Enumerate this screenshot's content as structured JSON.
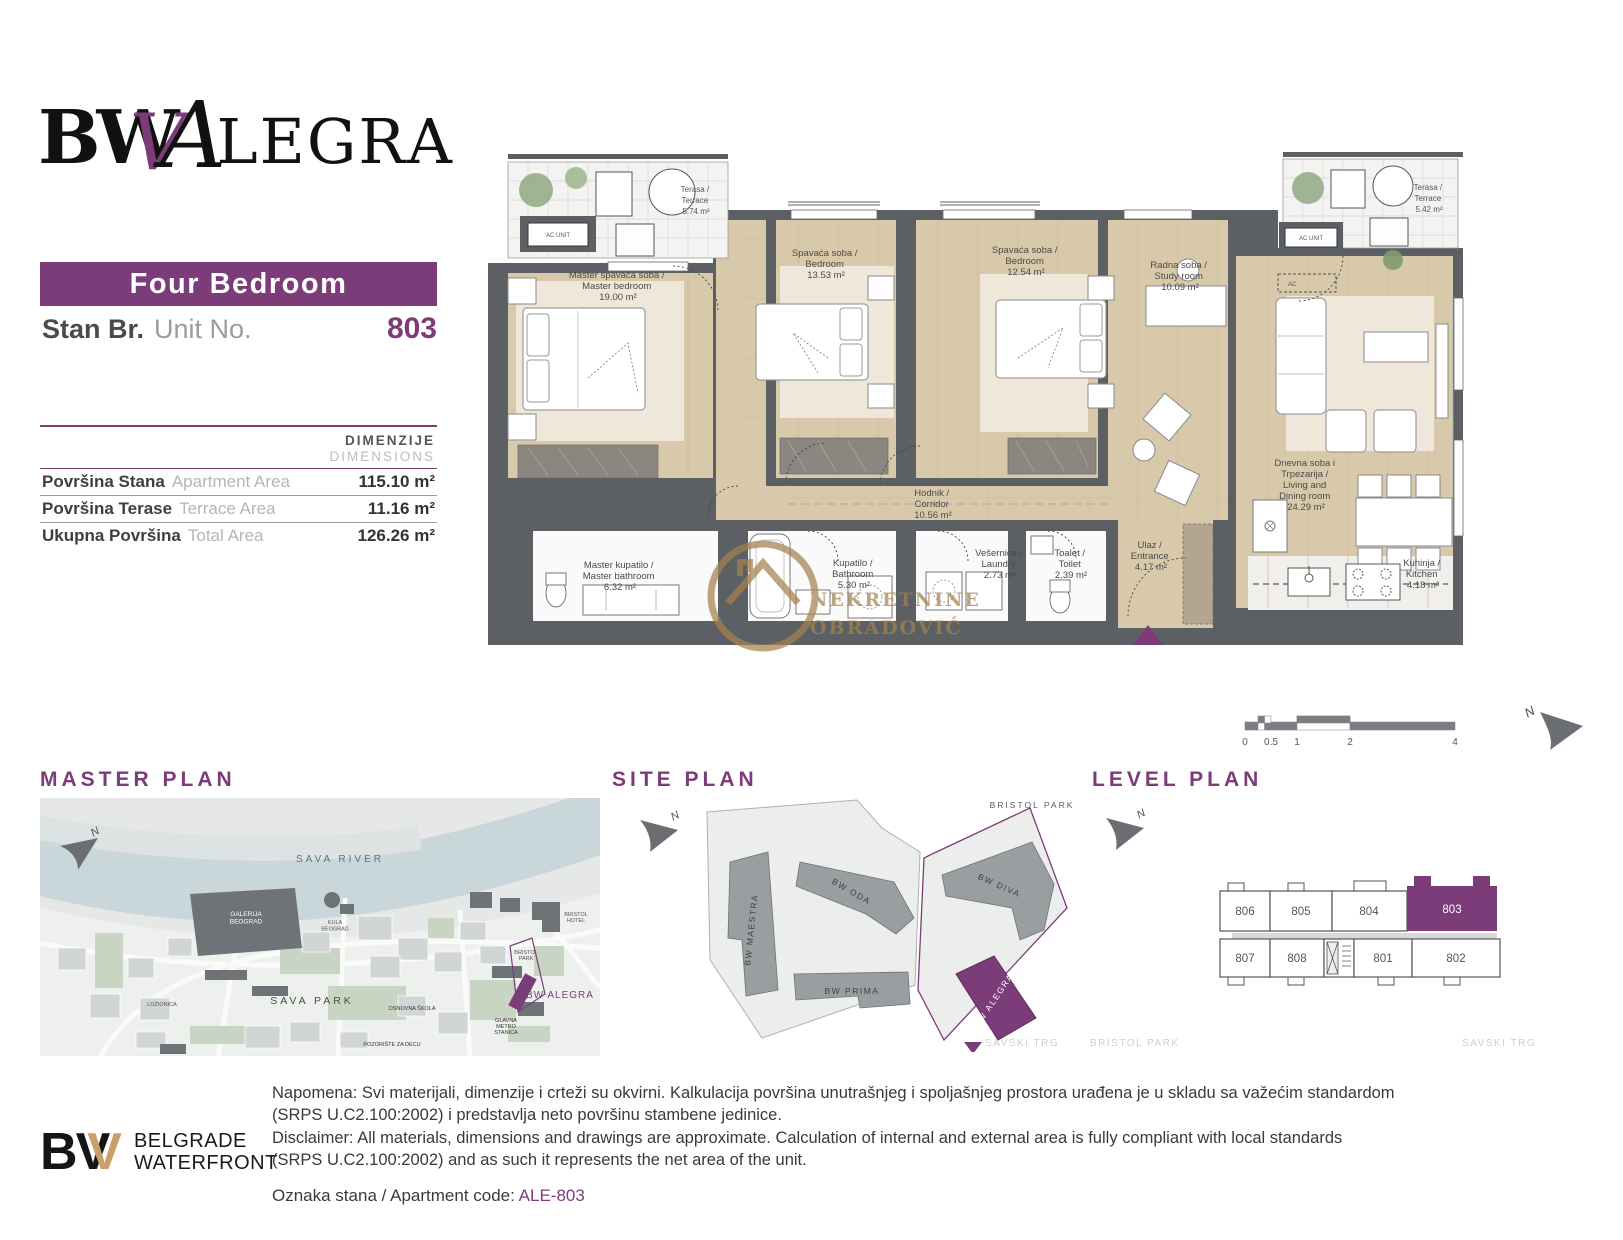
{
  "colors": {
    "accent": "#7b3c79",
    "wall": "#5c6064",
    "floor": "#d9c9ab",
    "rug": "#efe7d9",
    "terrace": "#f3f3f1",
    "bath": "#fafafa",
    "watermark_gold": "#a5824f",
    "logo_gold": "#c9a06a",
    "river": "#c9d6da",
    "map_green": "#c8d5c2",
    "map_block": "#d2d5d6",
    "map_dark": "#6e7377",
    "site_building": "#9a9ea1"
  },
  "header": {
    "bw": "BW",
    "v": "V",
    "a": "A",
    "legra": "LEGRA"
  },
  "unit": {
    "type": "Four Bedroom",
    "stan": "Stan Br.",
    "unit_no": "Unit No.",
    "number": "803"
  },
  "dimensions": {
    "dimenzije": "DIMENZIJE",
    "dimensions": "DIMENSIONS",
    "rows": [
      {
        "sr": "Površina Stana",
        "en": "Apartment Area",
        "value": "115.10 m²"
      },
      {
        "sr": "Površina Terase",
        "en": "Terrace Area",
        "value": "11.16 m²"
      },
      {
        "sr": "Ukupna Površina",
        "en": "Total Area",
        "value": "126.26 m²"
      }
    ]
  },
  "plan": {
    "north": "N",
    "ac": "AC UNIT",
    "ac_small": "AC",
    "watermark1": "NEKRETNINE",
    "watermark2": "OBRADOVIĆ",
    "rooms": {
      "terrace_left": {
        "l1": "Terasa /",
        "l2": "Terrace",
        "l3": "5.74 m²"
      },
      "terrace_right": {
        "l1": "Terasa /",
        "l2": "Terrace",
        "l3": "5.42 m²"
      },
      "master_bedroom": {
        "l1": "Master spavaća soba /",
        "l2": "Master bedroom",
        "l3": "19.00 m²"
      },
      "bedroom2": {
        "l1": "Spavaća soba /",
        "l2": "Bedroom",
        "l3": "13.53 m²"
      },
      "bedroom3": {
        "l1": "Spavaća soba /",
        "l2": "Bedroom",
        "l3": "12.54 m²"
      },
      "study": {
        "l1": "Radna soba /",
        "l2": "Study room",
        "l3": "10.09 m²"
      },
      "living": {
        "l1": "Dnevna soba i",
        "l2": "Trpezarija /",
        "l3": "Living and",
        "l4": "Dining room",
        "l5": "24.29 m²"
      },
      "corridor": {
        "l1": "Hodnik /",
        "l2": "Corridor",
        "l3": "10.56 m²"
      },
      "master_bath": {
        "l1": "Master kupatilo /",
        "l2": "Master bathroom",
        "l3": "6.32 m²"
      },
      "bathroom": {
        "l1": "Kupatilo /",
        "l2": "Bathroom",
        "l3": "5.30 m²"
      },
      "laundry": {
        "l1": "Vešernica /",
        "l2": "Laundry",
        "l3": "2.73 m²"
      },
      "toilet": {
        "l1": "Toalet /",
        "l2": "Toilet",
        "l3": "2.39 m²"
      },
      "entrance": {
        "l1": "Ulaz /",
        "l2": "Entrance",
        "l3": "4.17 m²"
      },
      "kitchen": {
        "l1": "Kuhinja /",
        "l2": "Kitchen",
        "l3": "4.18 m²"
      }
    }
  },
  "scale": {
    "t0": "0",
    "t1": "0.5",
    "t2": "1",
    "t3": "2",
    "t4": "4"
  },
  "master_plan": {
    "title": "MASTER PLAN",
    "river": "SAVA RIVER",
    "galerija1": "GALERIJA",
    "galerija2": "BEOGRAD",
    "kula1": "KULA",
    "kula2": "BEOGRAD",
    "sava_park": "SAVA PARK",
    "lozionica": "LOŽIONICA",
    "skola": "OSNOVNA ŠKOLA",
    "pozoriste": "POZORIŠTE ZA DECU",
    "metro1": "GLAVNA",
    "metro2": "METRO",
    "metro3": "STANICA",
    "bristol_park1": "BRISTOL",
    "bristol_park2": "PARK",
    "bristol_hotel1": "BRISTOL",
    "bristol_hotel2": "HOTEL",
    "alegra": "BW ALEGRA"
  },
  "site_plan": {
    "title": "SITE PLAN",
    "maestra": "BW MAESTRA",
    "oda": "BW ODA",
    "diva": "BW DIVA",
    "prima": "BW PRIMA",
    "alegra": "BW ALEGRA",
    "bristol_park": "BRISTOL PARK",
    "savski_trg_left": "SAVSKI TRG",
    "bristol_park_bottom": "BRISTOL PARK",
    "savski_trg_right": "SAVSKI TRG"
  },
  "level_plan": {
    "title": "LEVEL PLAN",
    "u806": "806",
    "u805": "805",
    "u804": "804",
    "u803": "803",
    "u807": "807",
    "u808": "808",
    "u801": "801",
    "u802": "802"
  },
  "footer": {
    "logo_b": "B",
    "logo_w": "V",
    "logo_v": "V",
    "brand1": "BELGRADE",
    "brand2": "WATERFRONT",
    "note1": "Napomena: Svi materijali, dimenzije i crteži su okvirni. Kalkulacija površina unutrašnjeg i spoljašnjeg prostora urađena je u skladu sa važećim standardom",
    "note2": "(SRPS U.C2.100:2002) i predstavlja neto površinu stambene jedinice.",
    "disc1": "Disclaimer: All materials, dimensions and drawings are approximate. Calculation of internal and external area is fully compliant with local standards",
    "disc2": "(SRPS U.C2.100:2002) and as such it represents the net area of the unit.",
    "code_label": "Oznaka stana / Apartment code:",
    "code": "ALE-803"
  }
}
